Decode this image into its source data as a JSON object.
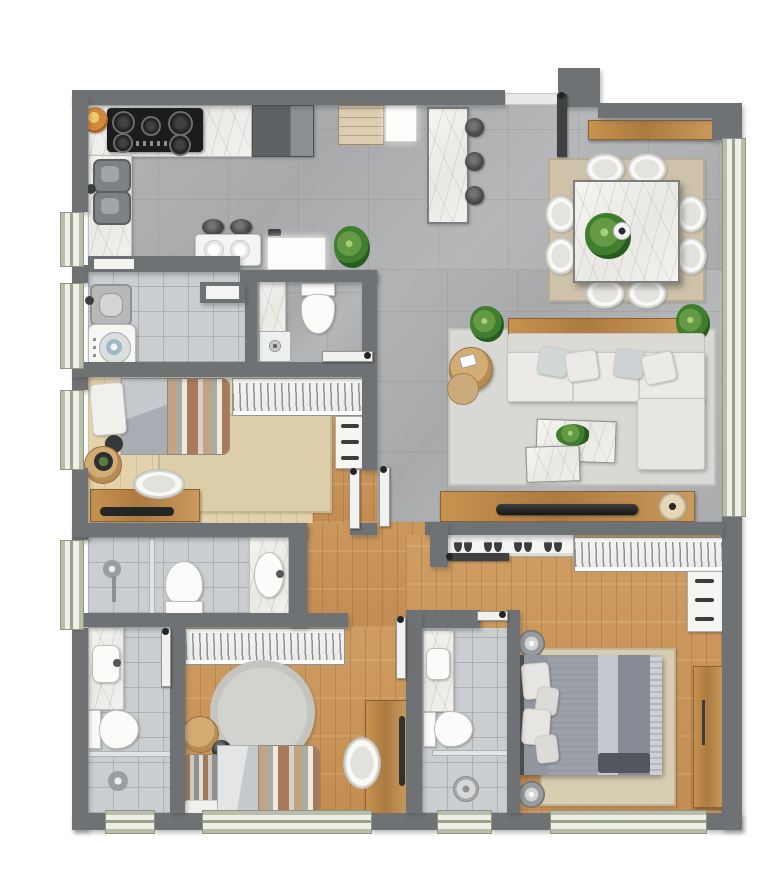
{
  "meta": {
    "kind": "architectural-floor-plan",
    "view": "top-down-rendered",
    "canvas": {
      "width": 768,
      "height": 894
    },
    "visible_text": []
  },
  "palette": {
    "wall": "#6f7274",
    "floor-gray": "#acaeb0",
    "floor-tile": "#cbced0",
    "floor-wood": "#cb9a60",
    "floor-pale-wood": "#e3d0aa",
    "marble": "#f2f1ee",
    "furniture-wood": "#b8834a",
    "sofa": "#e9e8e4",
    "window-sill": "#c2c7b2",
    "window-glass": "#edf0e8",
    "bed-gray": "#9296a0",
    "rug-beige": "#cfc3ab",
    "rug-gray": "#d8d8d4",
    "plant-green": "#4d8a3a",
    "stool-dark": "#46484a",
    "appliance-black": "#1b1d1f"
  },
  "rooms": [
    {
      "id": "kitchen",
      "furniture": [
        "l-shaped-marble-counter",
        "cooktop-5-burner",
        "double-sink",
        "fruit-bowl",
        "refrigerator",
        "pantry-cabinet",
        "tall-cabinet",
        "marble-island",
        "bar-stools-x3",
        "breakfast-table",
        "breakfast-stools-x2",
        "white-cabinet",
        "plant"
      ]
    },
    {
      "id": "laundry",
      "furniture": [
        "laundry-tank",
        "washing-machine",
        "wall-niche"
      ]
    },
    {
      "id": "powder-bathroom",
      "furniture": [
        "marble-vanity",
        "toilet",
        "shower-tray",
        "wall-niche"
      ]
    },
    {
      "id": "dining",
      "furniture": [
        "beige-rug",
        "marble-table",
        "chairs-x8",
        "table-plant",
        "wood-sideboard"
      ]
    },
    {
      "id": "living",
      "furniture": [
        "gray-rug",
        "wood-console",
        "plants-x2",
        "l-shaped-sofa",
        "cushions-x4",
        "round-side-tables-x2",
        "marble-coffee-tables-x2",
        "tv-console",
        "tv",
        "decor-bowl"
      ]
    },
    {
      "id": "bedroom-1",
      "furniture": [
        "single-bed-striped",
        "round-side-table",
        "beige-rug",
        "desk-with-tv",
        "chair",
        "wardrobe-hangers",
        "drawer-dresser"
      ]
    },
    {
      "id": "bathroom-1",
      "furniture": [
        "shower",
        "toilet",
        "marble-vanity"
      ]
    },
    {
      "id": "bedroom-2",
      "furniture": [
        "wardrobe-hangers",
        "round-gray-rug",
        "bed-striped",
        "round-side-table",
        "desk",
        "chair"
      ]
    },
    {
      "id": "bathroom-2",
      "furniture": [
        "marble-vanity",
        "toilet",
        "shower"
      ]
    },
    {
      "id": "master-suite",
      "furniture": [
        "shoe-rack",
        "wardrobe-hangers",
        "drawer-dresser",
        "double-bed-gray",
        "round-nightlamps-x2",
        "beige-rug",
        "wood-bench"
      ]
    },
    {
      "id": "bathroom-3",
      "furniture": [
        "marble-vanity",
        "toilet",
        "shower-glass"
      ]
    }
  ],
  "counts": {
    "windows": 10,
    "door-leaves": 8,
    "dining-chairs": 8,
    "bar-stools": 3,
    "plants": 5,
    "bathrooms": 4,
    "bedrooms": 3
  }
}
